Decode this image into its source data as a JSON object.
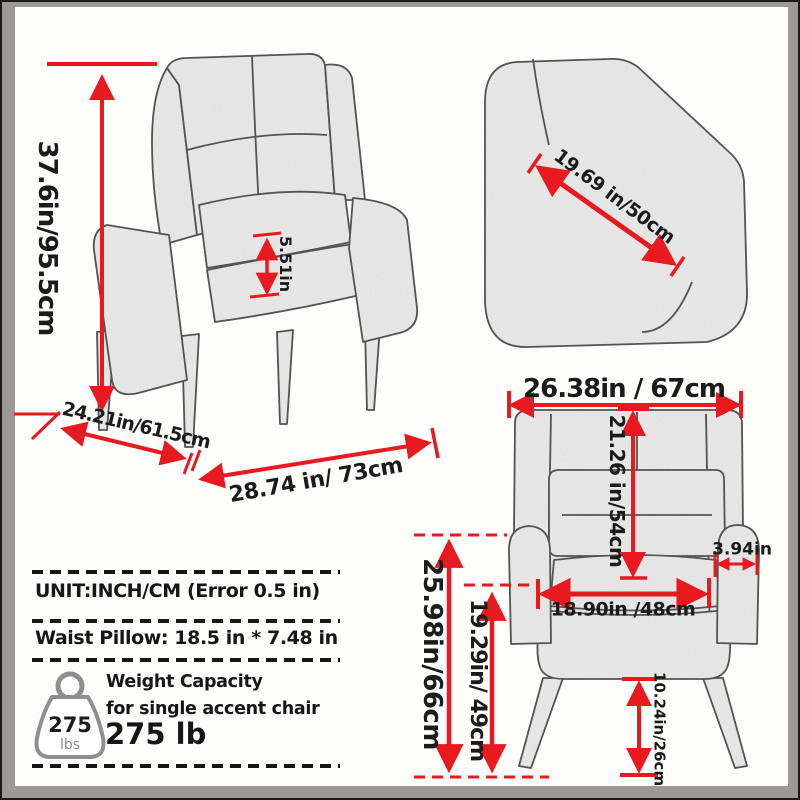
{
  "colors": {
    "accent_red": "#e8191f",
    "text_black": "#1b1b1b",
    "frame_gray": "#9c9a99",
    "paper_white": "#fdfdfc"
  },
  "views": {
    "angled_view": {
      "overall_height": "37.6in/95.5cm",
      "seat_front_thickness": "5.51in",
      "depth": "24.21in/61.5cm",
      "floor_width": "28.74 in/ 73cm"
    },
    "backrest_closeup": {
      "back_diagonal": "19.69 in/50cm"
    },
    "front_view": {
      "top_width": "26.38in / 67cm",
      "backrest_height": "21.26 in/54cm",
      "armrest_width": "3.94in",
      "seat_width": "18.90in /48cm",
      "arm_height_from_floor": "25.98in/66cm",
      "seat_height_from_floor": "19.29in/ 49cm",
      "leg_height": "10.24in/26cm"
    }
  },
  "info_box": {
    "unit_line": "UNIT:INCH/CM (Error 0.5 in)",
    "pillow_line": "Waist Pillow: 18.5 in * 7.48 in",
    "weight_capacity_title": "Weight Capacity",
    "weight_capacity_subtitle": "for single accent chair",
    "weight_capacity_value": "275 lb",
    "weight_icon": {
      "value": "275",
      "unit": "lbs"
    }
  }
}
